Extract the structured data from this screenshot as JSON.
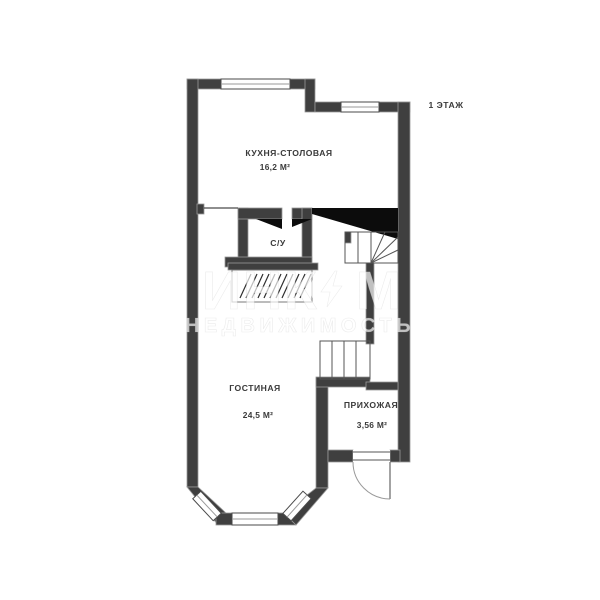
{
  "page": {
    "width": 600,
    "height": 600,
    "background": "#ffffff",
    "floor_label": "1 ЭТАЖ"
  },
  "plan": {
    "rooms": [
      {
        "id": "kitchen-dining",
        "name": "КУХНЯ-СТОЛОВАЯ",
        "area": "16,2 М²"
      },
      {
        "id": "bathroom",
        "name": "С/У"
      },
      {
        "id": "living-room",
        "name": "ГОСТИНАЯ",
        "area": "24,5 М²"
      },
      {
        "id": "hallway",
        "name": "ПРИХОЖАЯ",
        "area": "3,56 М²"
      }
    ],
    "colors": {
      "wall": "#3f3f3f",
      "stair_cut": "#0c0c0c",
      "thin_line": "#4a4a4a",
      "label_text": "#3a3a3a",
      "background": "#ffffff"
    }
  },
  "watermark": {
    "brand": "ИНКОМ",
    "brand_left": "ИНК",
    "brand_right": "М",
    "subtitle": "НЕДВИЖИМОСТЬ",
    "color": "#ffffff"
  }
}
